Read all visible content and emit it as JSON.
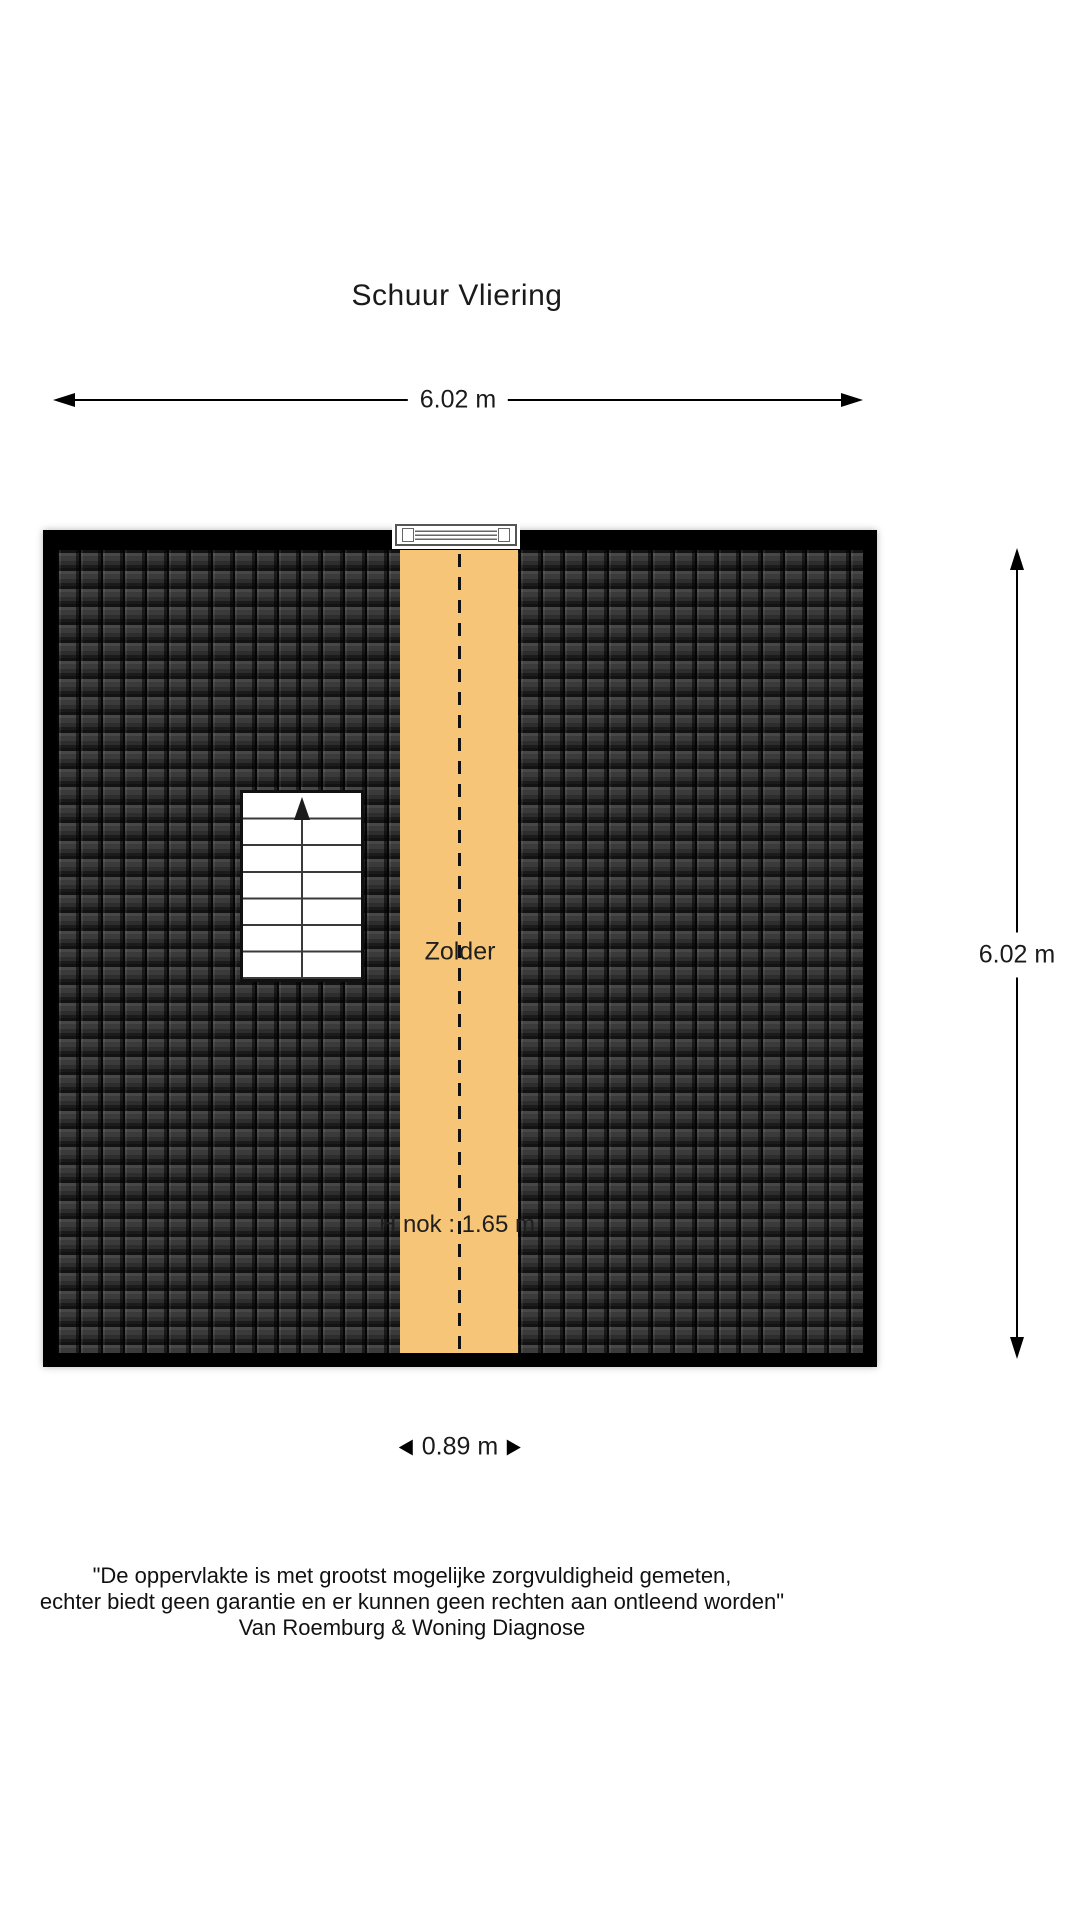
{
  "title": "Schuur Vliering",
  "plan": {
    "room_label": "Zolder",
    "ridge_height_label": "H nok : 1.65 m"
  },
  "dimensions": {
    "top": "6.02 m",
    "right": "6.02 m",
    "bottom": "0.89 m"
  },
  "colors": {
    "floor_area": "#F7C577",
    "roof_tiles": "#2e2e2e",
    "walls": "#000000",
    "text": "#1a1a1a"
  },
  "disclaimer": {
    "line1": "\"De oppervlakte is met grootst mogelijke zorgvuldigheid gemeten,",
    "line2": "echter biedt geen garantie en er kunnen geen rechten aan ontleend worden\"",
    "line3": "Van Roemburg & Woning Diagnose"
  }
}
